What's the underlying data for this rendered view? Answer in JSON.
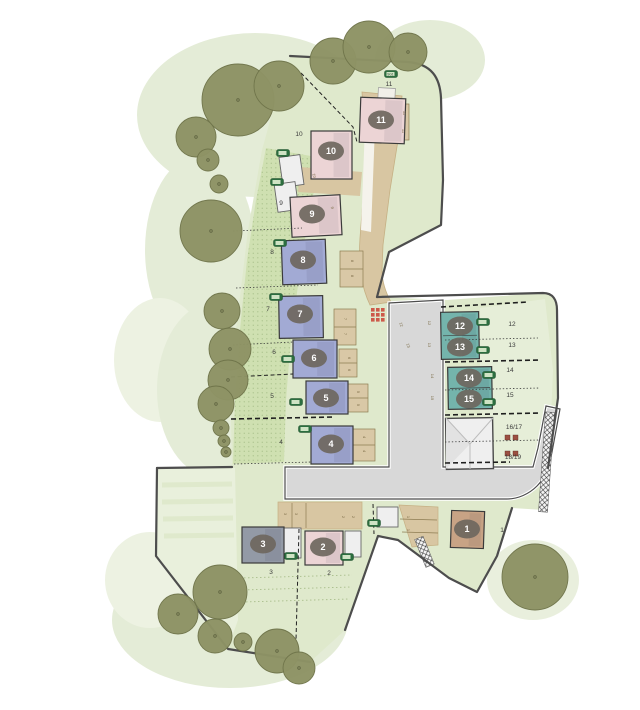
{
  "colors": {
    "background": "#ffffff",
    "canopy": "#e4ecd7",
    "canopy_dark": "#d9e4c6",
    "site_green": "#dfe9cc",
    "field_green": "#e9f0dc",
    "garden_green": "#cddfae",
    "garden_dot": "#a9c189",
    "east_lawn": "#e7eed9",
    "tree_fill": "#8e9365",
    "tree_edge": "#6f744a",
    "road_fill": "#d8d8d8",
    "road_edge": "#4c4c4c",
    "drive_fill": "#d8c6a2",
    "drive_edge": "#b6a172",
    "bay_fill": "#d9c8a6",
    "bay_edge": "#8d7c52",
    "house_pink": "#ecd4d5",
    "house_blue": "#a2aad4",
    "house_teal": "#74b4ac",
    "house_gray": "#939aa6",
    "house_tan": "#c8a385",
    "garage_fill": "#efefef",
    "garage_edge": "#555555",
    "badge_fill": "#6e675e",
    "badge_text": "#ffffff",
    "label_text": "#3c3c3c",
    "bay_label_text": "#7a6a45",
    "store_green": "#2c6e3f",
    "red_marker": "#cc4b3d",
    "boundary": "#4d4d4d"
  },
  "stores": {
    "label": "SG1"
  },
  "houses": [
    {
      "plot": "11",
      "type": "pink",
      "x": 360,
      "y": 98,
      "w": 45,
      "h": 45,
      "rot": 2
    },
    {
      "plot": "10",
      "type": "pink",
      "x": 311,
      "y": 131,
      "w": 41,
      "h": 48,
      "rot": 0
    },
    {
      "plot": "9",
      "type": "pink",
      "x": 291,
      "y": 196,
      "w": 50,
      "h": 40,
      "rot": -3
    },
    {
      "plot": "8",
      "type": "blue",
      "x": 282,
      "y": 240,
      "w": 44,
      "h": 44,
      "rot": -2
    },
    {
      "plot": "7",
      "type": "blue",
      "x": 279,
      "y": 296,
      "w": 44,
      "h": 42,
      "rot": -1
    },
    {
      "plot": "6",
      "type": "blue",
      "x": 293,
      "y": 340,
      "w": 44,
      "h": 38,
      "rot": 0
    },
    {
      "plot": "5",
      "type": "blue",
      "x": 306,
      "y": 381,
      "w": 42,
      "h": 33,
      "rot": 0
    },
    {
      "plot": "4",
      "type": "blue",
      "x": 311,
      "y": 426,
      "w": 42,
      "h": 38,
      "rot": 0
    },
    {
      "plot": "12-13",
      "type": "teal",
      "x": 441,
      "y": 312,
      "w": 38,
      "h": 47,
      "rot": -1
    },
    {
      "plot": "14-15",
      "type": "teal",
      "x": 448,
      "y": 367,
      "w": 44,
      "h": 42,
      "rot": -1
    },
    {
      "plot": "3",
      "type": "gray",
      "x": 242,
      "y": 527,
      "w": 42,
      "h": 36,
      "rot": 0
    },
    {
      "plot": "2",
      "type": "pink",
      "x": 305,
      "y": 531,
      "w": 38,
      "h": 34,
      "rot": 0
    },
    {
      "plot": "1",
      "type": "tan",
      "x": 451,
      "y": 511,
      "w": 33,
      "h": 37,
      "rot": 2
    }
  ],
  "plot_badges": [
    {
      "label": "1",
      "x": 467,
      "y": 529
    },
    {
      "label": "2",
      "x": 323,
      "y": 547
    },
    {
      "label": "3",
      "x": 263,
      "y": 544
    },
    {
      "label": "4",
      "x": 331,
      "y": 444
    },
    {
      "label": "5",
      "x": 326,
      "y": 398
    },
    {
      "label": "6",
      "x": 314,
      "y": 358
    },
    {
      "label": "7",
      "x": 300,
      "y": 314
    },
    {
      "label": "8",
      "x": 303,
      "y": 260
    },
    {
      "label": "9",
      "x": 312,
      "y": 214
    },
    {
      "label": "10",
      "x": 331,
      "y": 151
    },
    {
      "label": "11",
      "x": 381,
      "y": 120
    },
    {
      "label": "12",
      "x": 460,
      "y": 326
    },
    {
      "label": "13",
      "x": 460,
      "y": 347
    },
    {
      "label": "14",
      "x": 469,
      "y": 378
    },
    {
      "label": "15",
      "x": 469,
      "y": 399
    }
  ],
  "garden_labels": [
    {
      "label": "1",
      "x": 502,
      "y": 532
    },
    {
      "label": "2",
      "x": 329,
      "y": 575
    },
    {
      "label": "3",
      "x": 271,
      "y": 574
    },
    {
      "label": "4",
      "x": 281,
      "y": 444
    },
    {
      "label": "5",
      "x": 272,
      "y": 398
    },
    {
      "label": "6",
      "x": 274,
      "y": 354
    },
    {
      "label": "7",
      "x": 268,
      "y": 311
    },
    {
      "label": "8",
      "x": 272,
      "y": 254
    },
    {
      "label": "9",
      "x": 281,
      "y": 205
    },
    {
      "label": "10",
      "x": 299,
      "y": 136
    },
    {
      "label": "11",
      "x": 389,
      "y": 86
    },
    {
      "label": "12",
      "x": 512,
      "y": 326
    },
    {
      "label": "13",
      "x": 512,
      "y": 347
    },
    {
      "label": "14",
      "x": 510,
      "y": 372
    },
    {
      "label": "15",
      "x": 510,
      "y": 397
    },
    {
      "label": "16/17",
      "x": 514,
      "y": 429
    },
    {
      "label": "18/19",
      "x": 513,
      "y": 459
    }
  ],
  "bay_labels": [
    {
      "t": "11",
      "x": 403,
      "y": 113,
      "r": 90
    },
    {
      "t": "11",
      "x": 402,
      "y": 131,
      "r": 90
    },
    {
      "t": "10",
      "x": 313,
      "y": 176,
      "r": 75
    },
    {
      "t": "9",
      "x": 331,
      "y": 208,
      "r": 80
    },
    {
      "t": "8",
      "x": 351,
      "y": 261,
      "r": 90
    },
    {
      "t": "8",
      "x": 351,
      "y": 276,
      "r": 90
    },
    {
      "t": "7",
      "x": 344,
      "y": 319,
      "r": 90
    },
    {
      "t": "7",
      "x": 344,
      "y": 334,
      "r": 90
    },
    {
      "t": "6",
      "x": 348,
      "y": 358,
      "r": 90
    },
    {
      "t": "6",
      "x": 348,
      "y": 370,
      "r": 90
    },
    {
      "t": "5",
      "x": 357,
      "y": 392,
      "r": 90
    },
    {
      "t": "5",
      "x": 357,
      "y": 405,
      "r": 90
    },
    {
      "t": "4",
      "x": 363,
      "y": 437,
      "r": 90
    },
    {
      "t": "4",
      "x": 363,
      "y": 451,
      "r": 90
    },
    {
      "t": "12",
      "x": 400,
      "y": 325,
      "r": 70
    },
    {
      "t": "13",
      "x": 407,
      "y": 346,
      "r": 70
    },
    {
      "t": "12",
      "x": 428,
      "y": 323,
      "r": 90
    },
    {
      "t": "13",
      "x": 428,
      "y": 345,
      "r": 90
    },
    {
      "t": "14",
      "x": 431,
      "y": 376,
      "r": 90
    },
    {
      "t": "15",
      "x": 431,
      "y": 398,
      "r": 90
    },
    {
      "t": "3",
      "x": 284,
      "y": 514,
      "r": 90
    },
    {
      "t": "3",
      "x": 295,
      "y": 514,
      "r": 90
    },
    {
      "t": "2",
      "x": 342,
      "y": 517,
      "r": 90
    },
    {
      "t": "2",
      "x": 352,
      "y": 517,
      "r": 90
    },
    {
      "t": "1",
      "x": 407,
      "y": 517,
      "r": 90
    },
    {
      "t": "1",
      "x": 407,
      "y": 530,
      "r": 90
    }
  ],
  "store_markers": [
    {
      "x": 391,
      "y": 74,
      "label": "SG1"
    },
    {
      "x": 283,
      "y": 153
    },
    {
      "x": 277,
      "y": 182
    },
    {
      "x": 280,
      "y": 243
    },
    {
      "x": 276,
      "y": 297
    },
    {
      "x": 288,
      "y": 359
    },
    {
      "x": 296,
      "y": 402
    },
    {
      "x": 305,
      "y": 429
    },
    {
      "x": 483,
      "y": 322
    },
    {
      "x": 483,
      "y": 350
    },
    {
      "x": 489,
      "y": 375
    },
    {
      "x": 489,
      "y": 402
    },
    {
      "x": 374,
      "y": 523
    },
    {
      "x": 291,
      "y": 556
    },
    {
      "x": 347,
      "y": 557
    }
  ],
  "trees": [
    {
      "x": 238,
      "y": 100,
      "r": 36
    },
    {
      "x": 279,
      "y": 86,
      "r": 25
    },
    {
      "x": 333,
      "y": 61,
      "r": 23
    },
    {
      "x": 369,
      "y": 47,
      "r": 26
    },
    {
      "x": 408,
      "y": 52,
      "r": 19
    },
    {
      "x": 196,
      "y": 137,
      "r": 20
    },
    {
      "x": 208,
      "y": 160,
      "r": 11
    },
    {
      "x": 219,
      "y": 184,
      "r": 9
    },
    {
      "x": 211,
      "y": 231,
      "r": 31
    },
    {
      "x": 222,
      "y": 311,
      "r": 18
    },
    {
      "x": 230,
      "y": 349,
      "r": 21
    },
    {
      "x": 228,
      "y": 380,
      "r": 20
    },
    {
      "x": 216,
      "y": 404,
      "r": 18
    },
    {
      "x": 221,
      "y": 428,
      "r": 8
    },
    {
      "x": 224,
      "y": 441,
      "r": 6
    },
    {
      "x": 226,
      "y": 452,
      "r": 5
    },
    {
      "x": 220,
      "y": 592,
      "r": 27
    },
    {
      "x": 178,
      "y": 614,
      "r": 20
    },
    {
      "x": 215,
      "y": 636,
      "r": 17
    },
    {
      "x": 243,
      "y": 642,
      "r": 9
    },
    {
      "x": 277,
      "y": 651,
      "r": 22
    },
    {
      "x": 299,
      "y": 668,
      "r": 16
    },
    {
      "x": 535,
      "y": 577,
      "r": 33
    }
  ]
}
